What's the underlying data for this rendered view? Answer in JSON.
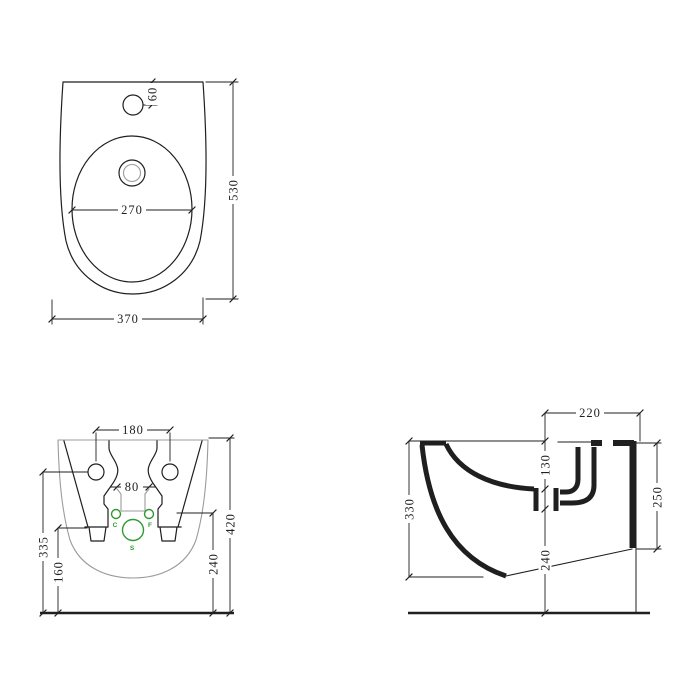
{
  "drawing": {
    "description": "Wall-hung bidet technical dimension drawing, three orthographic views",
    "colors": {
      "line": "#1f1f1f",
      "body_outline": "#9b9b9b",
      "connections": "#2e9b2e",
      "background": "#ffffff"
    },
    "views": {
      "top": {
        "name": "top view",
        "dims": {
          "faucet_hole_offset": "60",
          "basin_width": "270",
          "total_depth": "530",
          "total_width": "370"
        }
      },
      "rear": {
        "name": "rear view",
        "dims": {
          "fixing_hole_spacing": "180",
          "recess_width": "80",
          "fixing_hole_height": "335",
          "skirt_height": "160",
          "total_height": "420",
          "side_height": "240"
        },
        "connections": {
          "cold": "C",
          "hot": "F",
          "soil": "S"
        }
      },
      "side": {
        "name": "side section view",
        "dims": {
          "top_depth": "220",
          "rim_to_basin_depth": "130",
          "rear_height": "250",
          "front_height": "330",
          "outlet_height": "240"
        }
      }
    }
  }
}
